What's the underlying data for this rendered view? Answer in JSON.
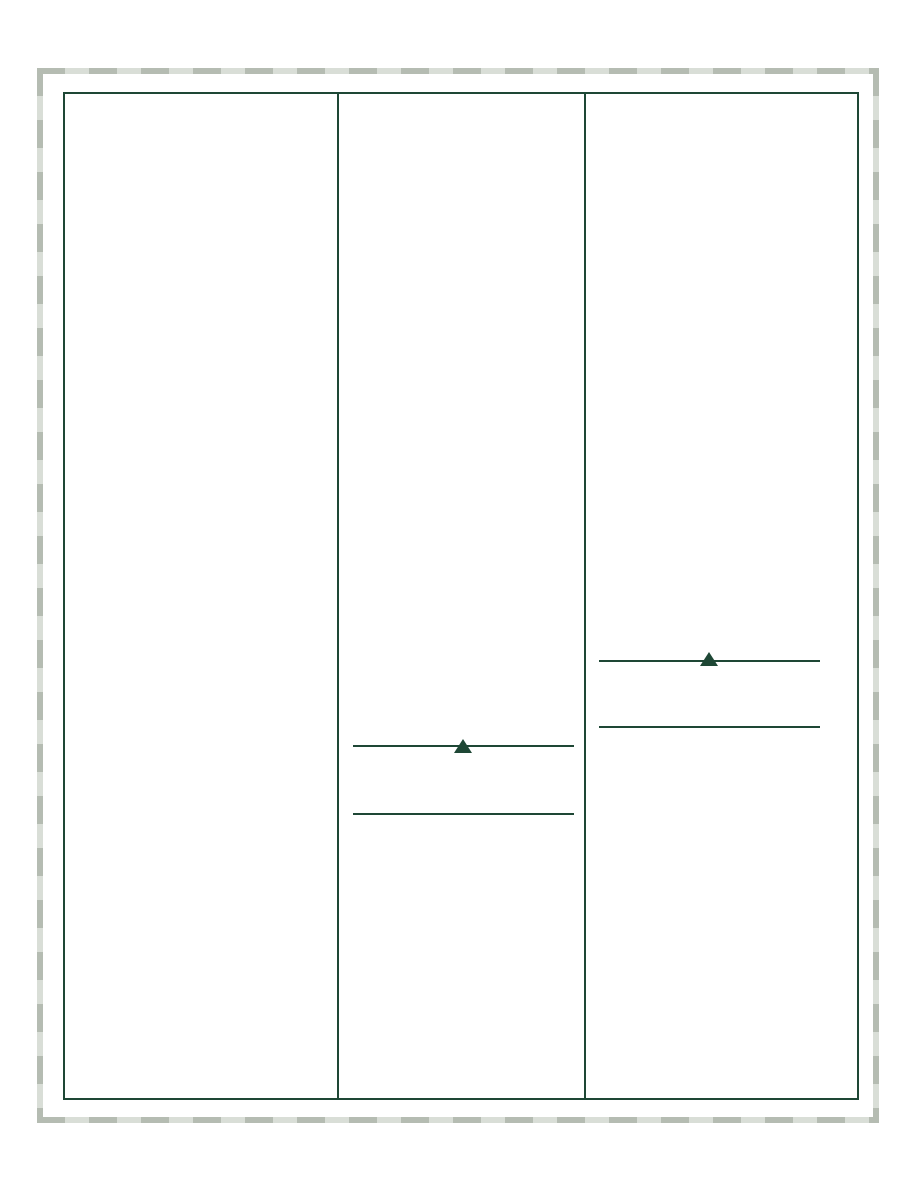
{
  "colors": {
    "page_background": "#ffffff",
    "accent_green": "#1e4735",
    "dash_dark": "#b5bcb2",
    "dash_light": "#d9ded7"
  },
  "frame": {
    "style": "dashed-cut-border"
  },
  "panels": {
    "count": 3,
    "left": {
      "content": ""
    },
    "middle": {
      "content": "",
      "marker_icon": "triangle-up-marker-icon",
      "rule_line_count": 2
    },
    "right": {
      "content": "",
      "marker_icon": "triangle-up-marker-icon",
      "rule_line_count": 2
    }
  }
}
